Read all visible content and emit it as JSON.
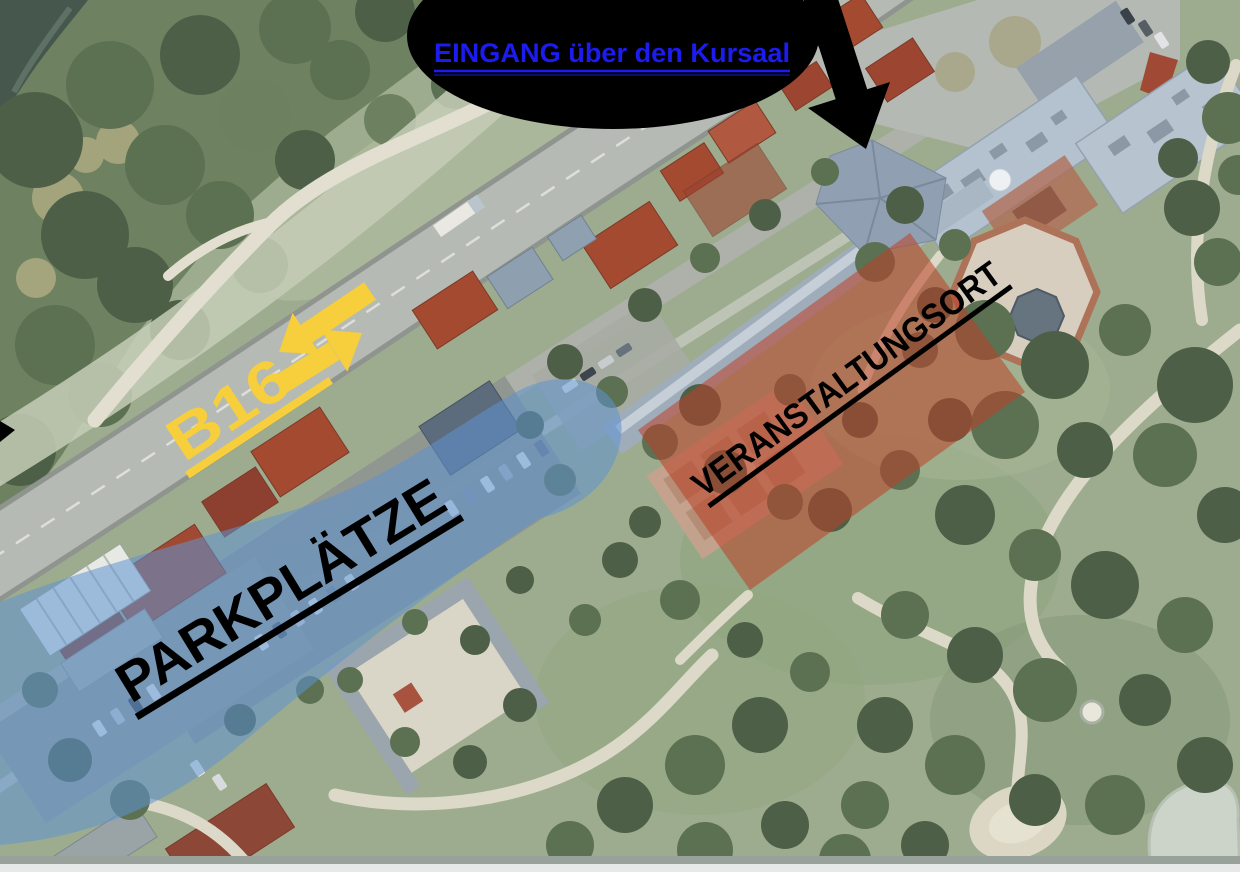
{
  "labels": {
    "entrance": "EINGANG über den Kursaal",
    "road": "B16",
    "parking": "PARKPLÄTZE",
    "venue": "VERANSTALTUNGSORT"
  },
  "colors": {
    "entrance_text": "#1c1cf0",
    "entrance_bubble": "#000000",
    "arrow": "#000000",
    "road_label": "#f7ce3c",
    "parking_zone": "#5f93d2",
    "venue_zone": "#bb3f27",
    "zone_label": "#000000"
  }
}
